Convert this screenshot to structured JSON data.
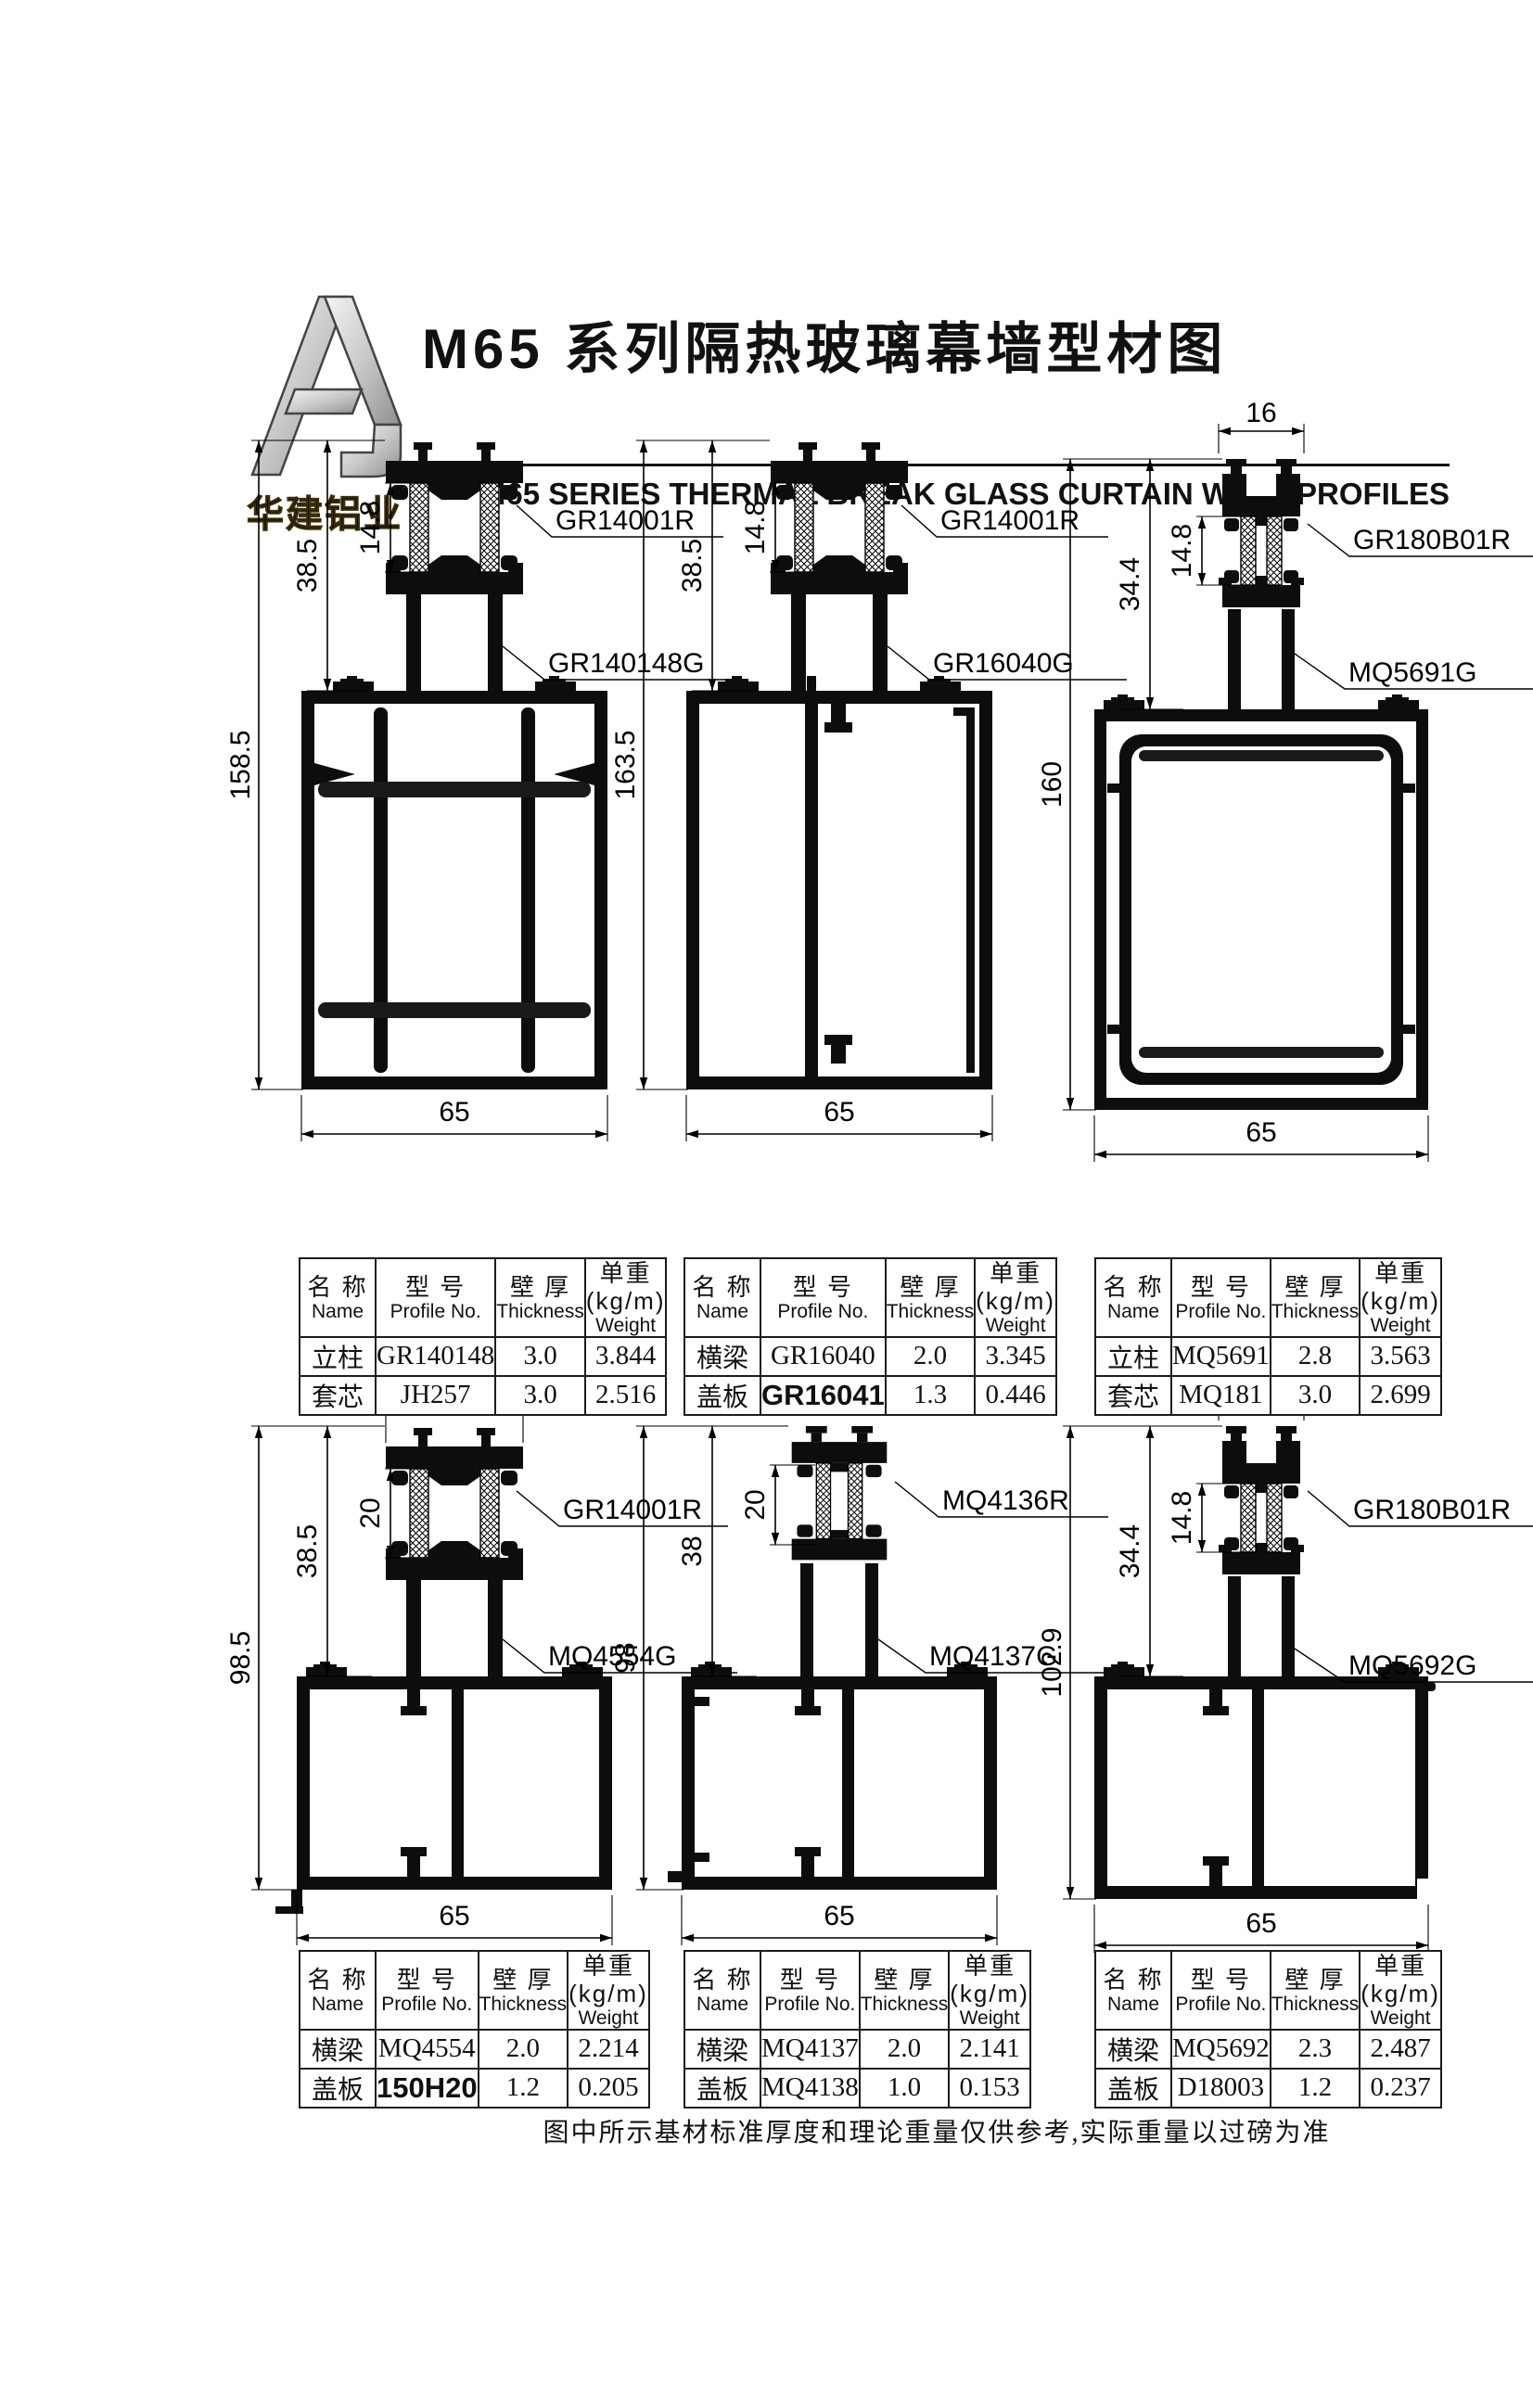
{
  "header": {
    "logo_text": "华建铝业",
    "title_cn": "M65 系列隔热玻璃幕墙型材图",
    "subtitle_en": "M65  SERIES THERMAL BREAK GLASS CURTAIN WALL PROFILES"
  },
  "table_headers": {
    "name_cn": "名 称",
    "name_en": "Name",
    "profile_cn": "型 号",
    "profile_en": "Profile No.",
    "thickness_cn": "壁 厚",
    "thickness_en": "Thickness",
    "weight_cn": "单重(kg/m)",
    "weight_en": "Weight"
  },
  "drawings": [
    {
      "labels": {
        "part1": "GR14001R",
        "part2": "GR140148G"
      },
      "dims": {
        "total_h": "158.5",
        "cap_h": "38.5",
        "iso_h": "14.8",
        "width": "65"
      }
    },
    {
      "labels": {
        "part1": "GR14001R",
        "part2": "GR16040G"
      },
      "dims": {
        "total_h": "163.5",
        "cap_h": "38.5",
        "iso_h": "14.8",
        "width": "65"
      }
    },
    {
      "labels": {
        "part1": "GR180B01R",
        "part2": "MQ5691G"
      },
      "dims": {
        "total_h": "160",
        "cap_h": "34.4",
        "iso_h": "14.8",
        "cap_w": "16",
        "width": "65"
      }
    },
    {
      "labels": {
        "part1": "GR14001R",
        "part2": "MQ4554G"
      },
      "dims": {
        "total_h": "98.5",
        "cap_h": "38.5",
        "iso_h": "20",
        "cap_w": "21",
        "width": "65"
      }
    },
    {
      "labels": {
        "part1": "MQ4136R",
        "part2": "MQ4137G"
      },
      "dims": {
        "total_h": "98",
        "cap_h": "38",
        "iso_h": "20",
        "width": "65"
      }
    },
    {
      "labels": {
        "part1": "GR180B01R",
        "part2": "MQ5692G"
      },
      "dims": {
        "total_h": "102.9",
        "cap_h": "34.4",
        "iso_h": "14.8",
        "cap_w": "16",
        "width": "65"
      }
    }
  ],
  "tables": [
    {
      "rows": [
        {
          "name": "立柱",
          "profile": "GR140148",
          "thickness": "3.0",
          "weight": "3.844"
        },
        {
          "name": "套芯",
          "profile": "JH257",
          "thickness": "3.0",
          "weight": "2.516"
        }
      ]
    },
    {
      "rows": [
        {
          "name": "横梁",
          "profile": "GR16040",
          "thickness": "2.0",
          "weight": "3.345"
        },
        {
          "name": "盖板",
          "profile": "GR16041",
          "thickness": "1.3",
          "weight": "0.446"
        }
      ]
    },
    {
      "rows": [
        {
          "name": "立柱",
          "profile": "MQ5691",
          "thickness": "2.8",
          "weight": "3.563"
        },
        {
          "name": "套芯",
          "profile": "MQ181",
          "thickness": "3.0",
          "weight": "2.699"
        }
      ]
    },
    {
      "rows": [
        {
          "name": "横梁",
          "profile": "MQ4554",
          "thickness": "2.0",
          "weight": "2.214"
        },
        {
          "name": "盖板",
          "profile": "150H20",
          "thickness": "1.2",
          "weight": "0.205"
        }
      ]
    },
    {
      "rows": [
        {
          "name": "横梁",
          "profile": "MQ4137",
          "thickness": "2.0",
          "weight": "2.141"
        },
        {
          "name": "盖板",
          "profile": "MQ4138",
          "thickness": "1.0",
          "weight": "0.153"
        }
      ]
    },
    {
      "rows": [
        {
          "name": "横梁",
          "profile": "MQ5692",
          "thickness": "2.3",
          "weight": "2.487"
        },
        {
          "name": "盖板",
          "profile": "D18003",
          "thickness": "1.2",
          "weight": "0.237"
        }
      ]
    }
  ],
  "footer": {
    "note": "图中所示基材标准厚度和理论重量仅供参考,实际重量以过磅为准"
  }
}
